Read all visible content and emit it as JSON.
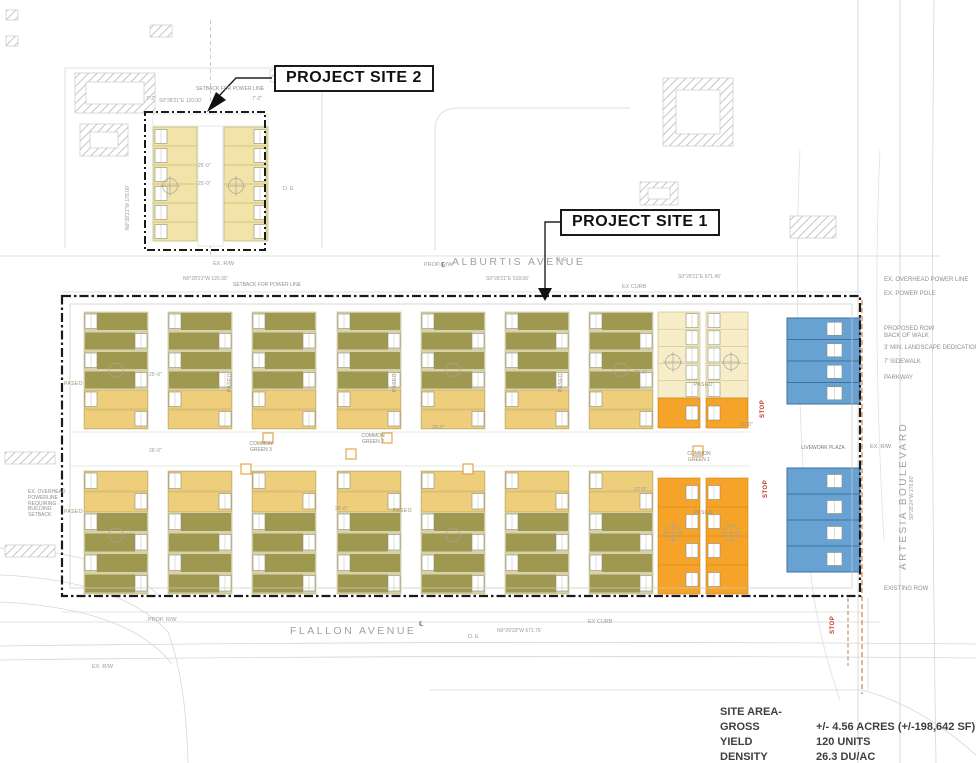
{
  "colors": {
    "olive": "#9f9850",
    "tan": "#d8d2aa",
    "gold": "#eecd7b",
    "yellow": "#f2e3a8",
    "pale": "#f7edc8",
    "orange": "#f5a329",
    "blue": "#68a2d2",
    "stop_red": "#c2372a",
    "orange_line": "#c97a3c",
    "hatch_gray": "#b9b9b9",
    "boundary_black": "#1a1a1a"
  },
  "callouts": {
    "site1": "PROJECT SITE 1",
    "site2": "PROJECT SITE 2"
  },
  "streets": {
    "top": "ALBURTIS AVENUE",
    "bottom": "FLALLON AVENUE",
    "right": "ARTESIA BOULEVARD"
  },
  "stats": {
    "rows": [
      {
        "label": "SITE AREA-GROSS",
        "value": "+/- 4.56 ACRES (+/-198,642 SF)"
      },
      {
        "label": "YIELD",
        "value": "120 UNITS"
      },
      {
        "label": "DENSITY",
        "value": "26.3 DU/AC"
      }
    ]
  },
  "greens": {
    "g3": "COMMON GREEN 3",
    "g2": "COMMON GREEN 2",
    "g1": "COMMON GREEN 1",
    "livework": "LIVEWORK PLAZA"
  },
  "labels": {
    "paseo": "PASEO",
    "stop": "STOP",
    "ex_overhead_power_line": "EX. OVERHEAD POWER LINE",
    "ex_power_pole": "EX. POWER POLE",
    "proposed_row": "PROPOSED ROW",
    "back_of_walk": "BACK OF WALK",
    "landscape_dedication": "3' MIN. LANDSCAPE DEDICATION",
    "sidewalk": "7' SIDEWALK",
    "parkway": "PARKWAY",
    "existing_row": "EXISTING ROW",
    "powerline_setback": "EX. OVERHEAD POWERLINE REQUIRING BUILDING SETBACK",
    "setback_for_power_line": "SETBACK FOR POWER LINE",
    "ex_rw": "EX. R/W",
    "prop_rw": "PROP. R/W",
    "ex_curb": "EX CURB",
    "de": "D. E",
    "cl": "℄"
  },
  "bearings": {
    "site2_top": "S0°28'21\"E  120.00'",
    "site2_left": "N0°28'21\"W  178.00'",
    "site2_bottom": "N0°28'21\"W  120.30'",
    "alburtis_west": "S0°28'21\"E  671.45'",
    "alburtis_center": "S0°28'21\"E  518.06'",
    "flallon": "N0°29'33\"W  671.76'",
    "artesia": "S0°28'24\"W  276.80'"
  },
  "dims": {
    "d25": "25'-0\"",
    "d26": "26'-0\"",
    "d27": "27'-0\"",
    "d72": "7'-2\""
  }
}
